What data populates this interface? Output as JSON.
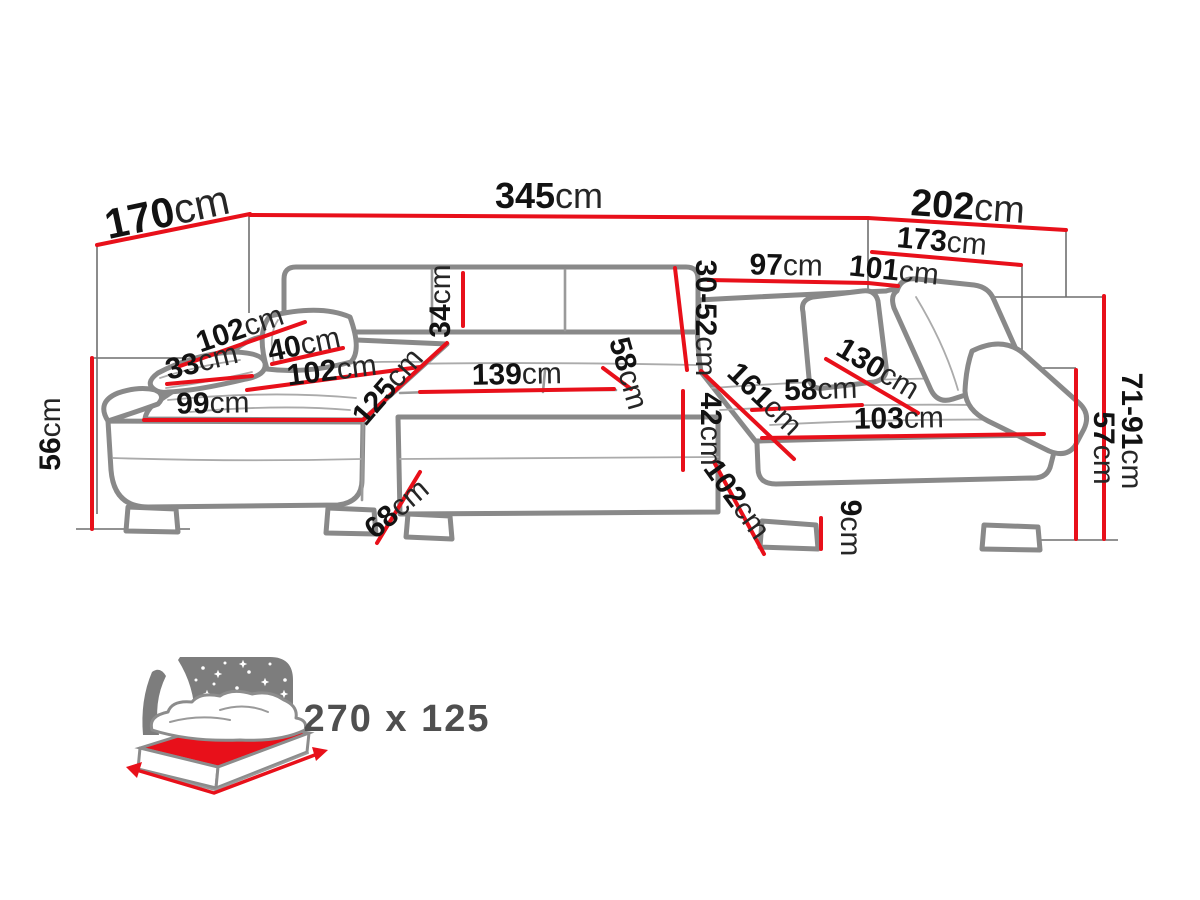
{
  "colors": {
    "dimension_line": "#e8101a",
    "sofa_outline": "#898989",
    "label_number": "#121212",
    "label_unit": "#262626",
    "badge_text": "#4f4f4f",
    "night_panel": "#7d7d7d"
  },
  "dimensions": [
    {
      "id": "width-left-170",
      "value": "170",
      "unit": "cm",
      "x": 170,
      "y": 226,
      "rotate": -12,
      "size": 42,
      "line": [
        97,
        245,
        250,
        214
      ]
    },
    {
      "id": "width-top-345",
      "value": "345",
      "unit": "cm",
      "x": 549,
      "y": 208,
      "rotate": 0,
      "size": 36,
      "line": [
        250,
        215,
        868,
        218
      ]
    },
    {
      "id": "width-right-202",
      "value": "202",
      "unit": "cm",
      "x": 967,
      "y": 219,
      "rotate": 4,
      "size": 38,
      "line": [
        868,
        218,
        1066,
        230
      ]
    },
    {
      "id": "width-right-173",
      "value": "173",
      "unit": "cm",
      "x": 941,
      "y": 251,
      "rotate": 5,
      "size": 30,
      "line": [
        872,
        252,
        1021,
        265
      ]
    },
    {
      "id": "back-width-97",
      "value": "97",
      "unit": "cm",
      "x": 786,
      "y": 275,
      "rotate": 1,
      "size": 30,
      "line": [
        708,
        280,
        868,
        283
      ]
    },
    {
      "id": "back-width-101",
      "value": "101",
      "unit": "cm",
      "x": 893,
      "y": 280,
      "rotate": 6,
      "size": 30,
      "line": [
        868,
        283,
        898,
        286
      ]
    },
    {
      "id": "arm-diag-102",
      "value": "102",
      "unit": "cm",
      "x": 243,
      "y": 338,
      "rotate": -19,
      "size": 30,
      "line": [
        180,
        366,
        305,
        322
      ]
    },
    {
      "id": "arm-pillow-33",
      "value": "33",
      "unit": "cm",
      "x": 204,
      "y": 371,
      "rotate": -14,
      "size": 30,
      "line": [
        167,
        384,
        252,
        376
      ]
    },
    {
      "id": "pillow-left-40",
      "value": "40",
      "unit": "cm",
      "x": 306,
      "y": 354,
      "rotate": -12,
      "size": 30,
      "line": [
        272,
        364,
        343,
        348
      ]
    },
    {
      "id": "seat-left-102",
      "value": "102",
      "unit": "cm",
      "x": 333,
      "y": 380,
      "rotate": -7,
      "size": 30,
      "line": [
        247,
        390,
        420,
        367
      ]
    },
    {
      "id": "chaise-front-99",
      "value": "99",
      "unit": "cm",
      "x": 213,
      "y": 413,
      "rotate": -1,
      "size": 30,
      "line": [
        144,
        420,
        363,
        420
      ]
    },
    {
      "id": "chaise-depth-125",
      "value": "125",
      "unit": "cm",
      "x": 395,
      "y": 393,
      "rotate": -49,
      "size": 30,
      "line": [
        363,
        420,
        447,
        343
      ]
    },
    {
      "id": "backrest-height-34",
      "value": "34",
      "unit": "cm",
      "x": 450,
      "y": 301,
      "rotate": -90,
      "size": 30,
      "line": [
        463,
        273,
        463,
        326
      ]
    },
    {
      "id": "headrest-range-3052",
      "value": "30-52",
      "unit": "cm",
      "x": 696,
      "y": 318,
      "rotate": 90,
      "size": 30,
      "line": [
        675,
        268,
        687,
        370
      ]
    },
    {
      "id": "center-width-139",
      "value": "139",
      "unit": "cm",
      "x": 517,
      "y": 384,
      "rotate": -1,
      "size": 30,
      "line": [
        420,
        392,
        614,
        389
      ]
    },
    {
      "id": "seat-depth-58-mid",
      "value": "58",
      "unit": "cm",
      "x": 619,
      "y": 376,
      "rotate": 74,
      "size": 30,
      "line": [
        603,
        368,
        631,
        389
      ]
    },
    {
      "id": "seat-height-42",
      "value": "42",
      "unit": "cm",
      "x": 701,
      "y": 429,
      "rotate": 90,
      "size": 30,
      "line": [
        683,
        391,
        683,
        470
      ]
    },
    {
      "id": "corner-depth-68",
      "value": "68",
      "unit": "cm",
      "x": 403,
      "y": 516,
      "rotate": -41,
      "size": 30,
      "line": [
        420,
        472,
        377,
        543
      ]
    },
    {
      "id": "corner-depth-102",
      "value": "102",
      "unit": "cm",
      "x": 729,
      "y": 505,
      "rotate": 54,
      "size": 30,
      "line": [
        714,
        462,
        764,
        554
      ]
    },
    {
      "id": "wing-length-161",
      "value": "161",
      "unit": "cm",
      "x": 758,
      "y": 406,
      "rotate": 44,
      "size": 30,
      "line": [
        701,
        371,
        794,
        459
      ]
    },
    {
      "id": "seat-depth-58-right",
      "value": "58",
      "unit": "cm",
      "x": 821,
      "y": 399,
      "rotate": -2,
      "size": 30,
      "line": [
        752,
        410,
        862,
        405
      ]
    },
    {
      "id": "wing-diag-130",
      "value": "130",
      "unit": "cm",
      "x": 873,
      "y": 377,
      "rotate": 31,
      "size": 30,
      "line": [
        826,
        359,
        918,
        413
      ]
    },
    {
      "id": "wing-front-103",
      "value": "103",
      "unit": "cm",
      "x": 899,
      "y": 428,
      "rotate": -1,
      "size": 30,
      "line": [
        762,
        438,
        1044,
        434
      ]
    },
    {
      "id": "leg-height-9",
      "value": "9",
      "unit": "cm",
      "x": 841,
      "y": 528,
      "rotate": 90,
      "size": 30,
      "line": [
        821,
        518,
        821,
        549
      ]
    },
    {
      "id": "height-range-7191",
      "value": "71-91",
      "unit": "cm",
      "x": 1122,
      "y": 431,
      "rotate": 90,
      "size": 30,
      "line": [
        1104,
        296,
        1104,
        539
      ]
    },
    {
      "id": "seat-height-57",
      "value": "57",
      "unit": "cm",
      "x": 1094,
      "y": 448,
      "rotate": 90,
      "size": 30,
      "line": [
        1076,
        370,
        1076,
        539
      ]
    },
    {
      "id": "height-left-56",
      "value": "56",
      "unit": "cm",
      "x": 60,
      "y": 434,
      "rotate": -90,
      "size": 30,
      "line": [
        92,
        358,
        92,
        529
      ]
    }
  ],
  "bed": {
    "badge": "270 x 125"
  }
}
